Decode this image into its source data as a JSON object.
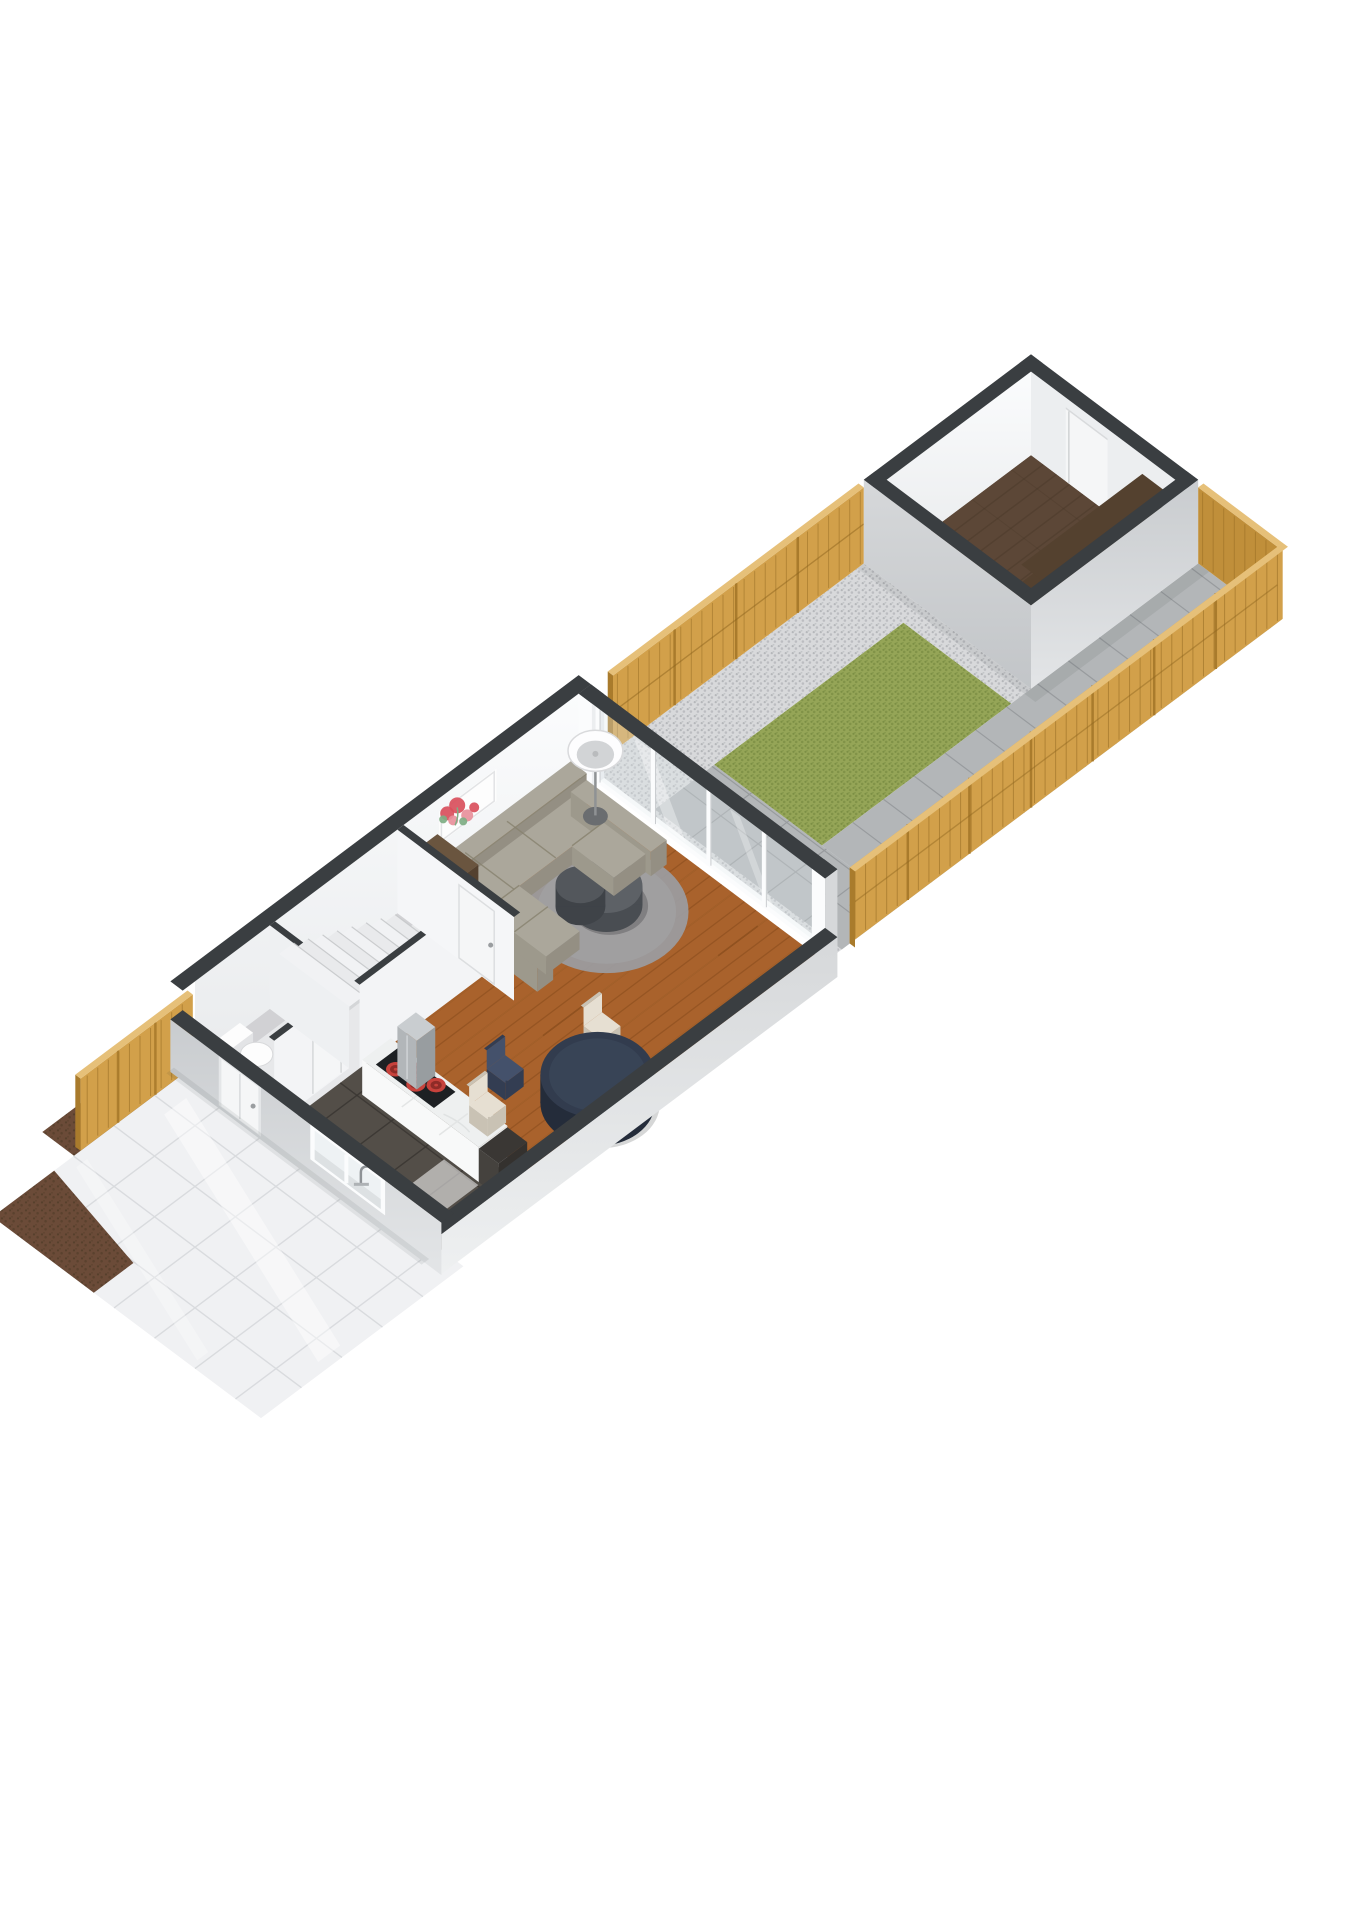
{
  "meta": {
    "title": "3D isometric floorplan render - ground floor of terraced house with front yard, garden and shed",
    "render_style": "cutaway-3d-floorplan",
    "visible_text": []
  },
  "canvas": {
    "width": 1358,
    "height": 1920,
    "background": "#ffffff"
  },
  "iso": {
    "origin_x": 195,
    "origin_y": 1065,
    "ax": 44,
    "ay": 33,
    "hz": 38
  },
  "colors": {
    "wall_cap": "#3a3e41",
    "wall_ext_light": "#d6d8da",
    "wall_ext_mid": "#c9cccf",
    "wall_int": "#f7f8f9",
    "wall_int_shade": "#eceef0",
    "glass": "#dfe8eb",
    "frame_white": "#fbfcfd",
    "wood_floor": "#a9622c",
    "wood_plank_line": "#84491a",
    "wood_highlight": "#c07a3e",
    "kitchen_tile": "#534e48",
    "kitchen_tile_line": "#3b3733",
    "hall_floor": "#e7e8ea",
    "stair_tread": "#f1f2f4",
    "fence_lit": "#d2a04a",
    "fence_mid": "#c08f3a",
    "fence_dark": "#a97b2c",
    "fence_top": "#e6c079",
    "fence_plank_line": "#8f661f",
    "gravel": "#d8d9db",
    "gravel_dot": "#b5b7ba",
    "grass": "#95a557",
    "grass_dot": "#7c8f45",
    "paving": "#b3b6b8",
    "paving_line": "#989b9e",
    "shed_floor": "#5c4737",
    "shed_plank_line": "#43332576",
    "shelf_wood": "#54412f",
    "shelf_edge": "#30261e",
    "sofa_top": "#aba79b",
    "sofa_side": "#948f83",
    "sofa_front": "#9d998c",
    "sofa_seam": "#87826f",
    "rug": "#9b9ca0",
    "coffee_table_side": "#494d52",
    "coffee_table_top": "#5d6166",
    "dirt": "#6b4b38",
    "dirt_dark": "#57402c",
    "yard_tile": "#f0f1f3",
    "yard_tile_line": "#d9dbde",
    "marble_top": "#eef0f0",
    "counter_white": "#f8f9f9",
    "cooktop": "#1d2023",
    "burner": "#c7423c",
    "burner_dark": "#8e2b27",
    "steel": "#b2b6b9",
    "steel_dark": "#989da0",
    "door_white": "#f5f6f7",
    "appliance_dark": "#3a3734",
    "art_red": "#d94f5c",
    "art_pink": "#e8909b",
    "art_green": "#7fae84",
    "table_navy_top": "#323c4e",
    "table_navy_side": "#242c3a",
    "chair_navy": "#44516b",
    "chair_cream": "#e6dfd2",
    "shadow": "rgba(40,44,48,0.16)"
  },
  "layout": {
    "house": {
      "len": 9.0,
      "wid": 5.6,
      "wall": 0.28,
      "wall_h": 2.2,
      "front_wall_h": 1.2,
      "se_wall_h": 0.9
    },
    "garden": {
      "u1": 9.0,
      "u2": 19.0,
      "gravel_w": 1.35,
      "path_v1": 3.8,
      "patio_u2": 10.45
    },
    "shed": {
      "u1": 15.2,
      "u2": 19.0,
      "wid": 3.8,
      "wall": 0.26,
      "wall_h": 2.2
    },
    "front_yard": {
      "len": 4.6,
      "wid": 6.1,
      "tile": 0.92
    },
    "fence_h": 2.0
  },
  "rooms": [
    {
      "name": "front-yard",
      "surface": "white-glossy-tiles",
      "features": [
        "dirt-border",
        "wood-fence"
      ]
    },
    {
      "name": "entry-hall",
      "surface": "light-gray-floor",
      "features": [
        "front-door",
        "staircase",
        "wc"
      ]
    },
    {
      "name": "wc",
      "surface": "light-gray-floor",
      "features": [
        "toilet",
        "sliding-door"
      ]
    },
    {
      "name": "kitchen",
      "surface": "dark-tile-floor",
      "features": [
        "island-counter",
        "cooktop",
        "extractor-hood",
        "sink-window"
      ]
    },
    {
      "name": "living-dining-room",
      "surface": "wood-plank-floor",
      "features": [
        "sectional-sofa",
        "rug",
        "coffee-table",
        "floor-lamp",
        "artwork",
        "dining-table",
        "sliding-glass-doors"
      ]
    },
    {
      "name": "garden",
      "surface": "lawn-gravel-paving",
      "features": [
        "wood-fence",
        "paved-path",
        "patio"
      ]
    },
    {
      "name": "shed",
      "surface": "dark-wood-floor",
      "features": [
        "shelving-rack",
        "shed-door"
      ]
    }
  ],
  "furniture": [
    {
      "name": "sectional-sofa",
      "color_key": "sofa_top"
    },
    {
      "name": "round-rug",
      "color_key": "rug"
    },
    {
      "name": "coffee-table-set",
      "color_key": "coffee_table_top"
    },
    {
      "name": "floor-lamp",
      "color_key": "frame_white"
    },
    {
      "name": "flower-artwork",
      "color_key": "art_red"
    },
    {
      "name": "dining-table",
      "color_key": "table_navy_top"
    },
    {
      "name": "dining-chair-navy",
      "color_key": "chair_navy"
    },
    {
      "name": "dining-chair-cream-1",
      "color_key": "chair_cream"
    },
    {
      "name": "dining-chair-cream-2",
      "color_key": "chair_cream"
    },
    {
      "name": "kitchen-island",
      "color_key": "counter_white"
    },
    {
      "name": "cooktop-4-burners",
      "color_key": "burner"
    },
    {
      "name": "extractor-hood",
      "color_key": "steel"
    },
    {
      "name": "dark-appliance",
      "color_key": "appliance_dark"
    },
    {
      "name": "sink-faucet",
      "color_key": "steel"
    },
    {
      "name": "hall-shelf-unit",
      "color_key": "shelf_wood"
    },
    {
      "name": "toilet",
      "color_key": "frame_white"
    },
    {
      "name": "shed-shelving-rack",
      "color_key": "shelf_wood"
    }
  ]
}
